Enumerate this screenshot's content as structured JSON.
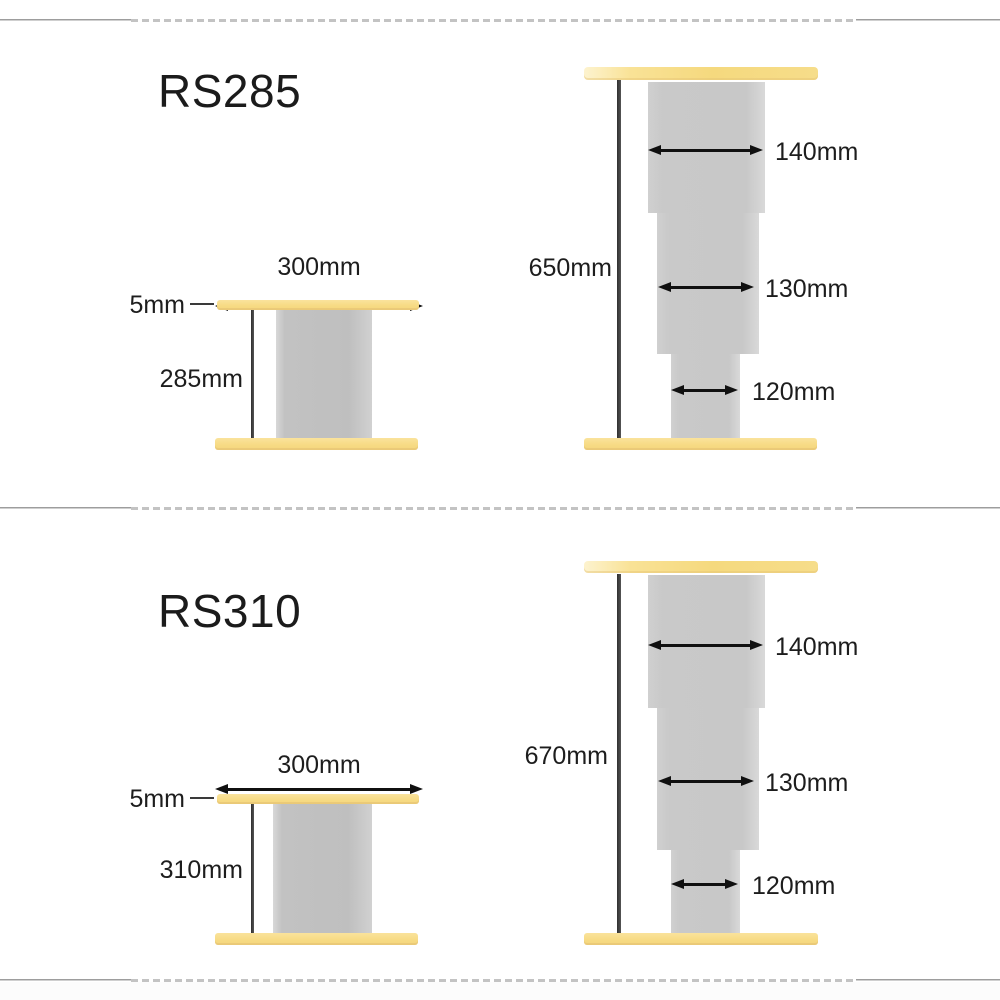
{
  "page": {
    "background": "#ffffff"
  },
  "colors": {
    "plate_yellow": "#f7db85",
    "column_gray": "#c6c6c6",
    "dimension_line_dark": "#3a3a3a",
    "arrow_black": "#101010",
    "text": "#1d1d1d",
    "divider_gray": "#c3c3c3"
  },
  "models": [
    {
      "id": "rs285",
      "title": "RS285",
      "front_view": {
        "top_width_label": "300mm",
        "plate_thickness_label": "5mm",
        "column_height_label": "285mm"
      },
      "side_view": {
        "overall_height_label": "650mm",
        "segment_width_labels": [
          "140mm",
          "130mm",
          "120mm"
        ]
      }
    },
    {
      "id": "rs310",
      "title": "RS310",
      "front_view": {
        "top_width_label": "300mm",
        "plate_thickness_label": "5mm",
        "column_height_label": "310mm"
      },
      "side_view": {
        "overall_height_label": "670mm",
        "segment_width_labels": [
          "140mm",
          "130mm",
          "120mm"
        ]
      }
    }
  ]
}
